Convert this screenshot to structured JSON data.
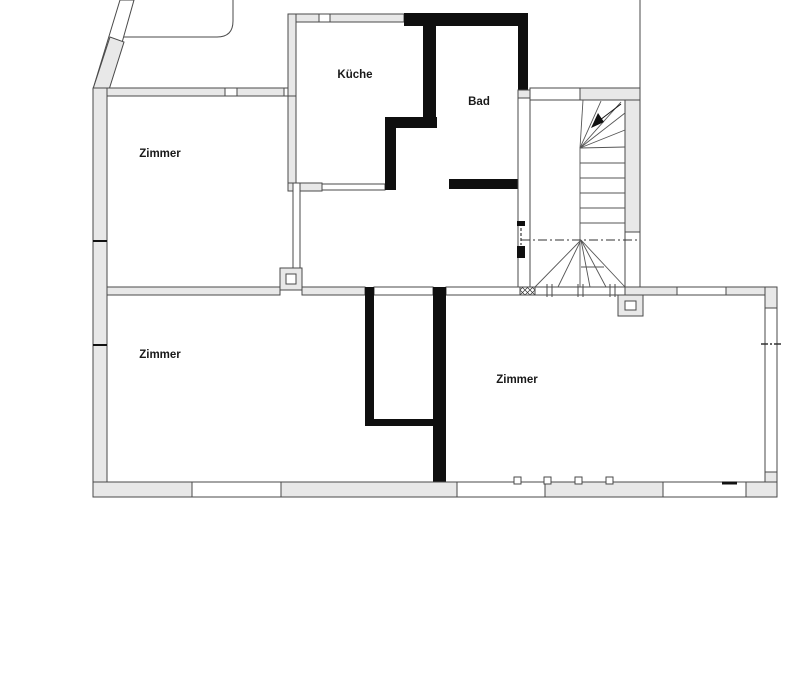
{
  "page": {
    "title": "Grundriss",
    "background_color": "#ffffff"
  },
  "plan": {
    "type": "floor-plan",
    "colors": {
      "wall_fill": "#e8e8e8",
      "wall_outline": "#4a4a4a",
      "solid_partition_wall": "#0f0f0f",
      "stair_lines": "#555555",
      "label_text": "#1a1a1a"
    },
    "rooms": [
      {
        "id": "zimmer-top-left",
        "label": "Zimmer"
      },
      {
        "id": "kueche",
        "label": "Küche"
      },
      {
        "id": "bad",
        "label": "Bad"
      },
      {
        "id": "zimmer-bottom-left",
        "label": "Zimmer"
      },
      {
        "id": "zimmer-bottom-right",
        "label": "Zimmer"
      }
    ],
    "stair": {
      "id": "winder-staircase",
      "arrow_icon": "stair-direction-arrow"
    },
    "symbols": [
      "chimney-pillar-left",
      "chimney-pillar-right",
      "wall-section-hatch",
      "window-breaks",
      "door-marks"
    ]
  }
}
